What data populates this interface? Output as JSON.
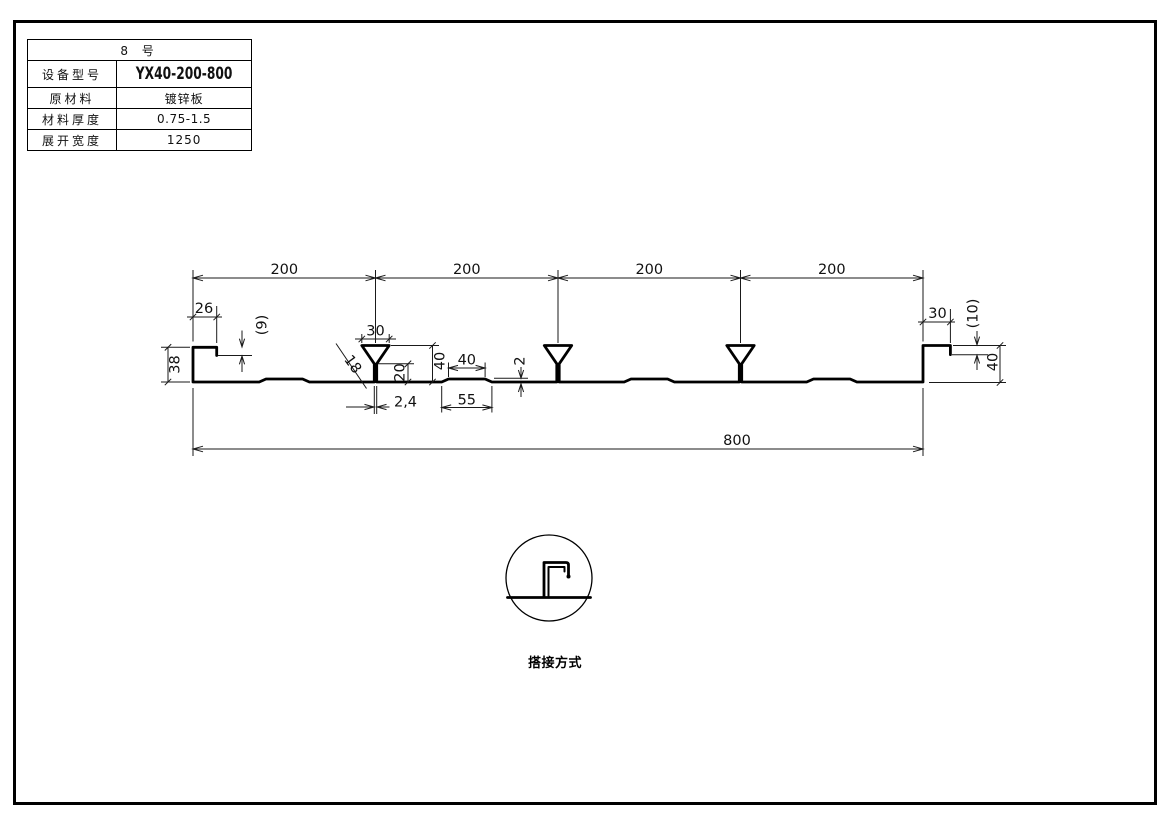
{
  "spec_table": {
    "title": "8 号",
    "rows": [
      {
        "label": "设备型号",
        "value": "YX40-200-800"
      },
      {
        "label": "原材料",
        "value": "镀锌板"
      },
      {
        "label": "材料厚度",
        "value": "0.75-1.5"
      },
      {
        "label": "展开宽度",
        "value": "1250"
      }
    ]
  },
  "dims": {
    "spans": [
      "200",
      "200",
      "200",
      "200"
    ],
    "total_width": "800",
    "left_lip_width": "26",
    "left_step_height": "(9)",
    "left_edge_height": "38",
    "rib_top_width": "30",
    "rib_side_length": "18",
    "rib_stem_height": "20",
    "rib_height": "40",
    "rib_stem_width": "2,4",
    "flute_top_width": "40",
    "flute_bottom_width": "55",
    "flute_height": "2",
    "right_lip_width": "30",
    "right_step_height": "(10)",
    "right_edge_height": "40"
  },
  "detail": {
    "caption": "搭接方式"
  }
}
